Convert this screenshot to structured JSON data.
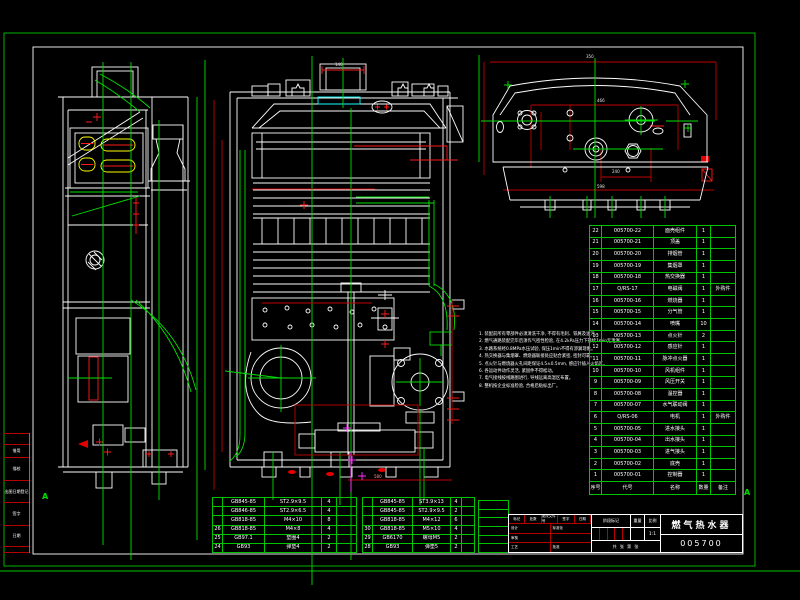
{
  "drawing": {
    "title": "燃气热水器",
    "drawing_number": "005700",
    "zone_marker": "A"
  },
  "margin_strip": {
    "labels": [
      "借用",
      "描校",
      "出图日期登记",
      "签字",
      "日期"
    ]
  },
  "dims": {
    "top_width": "350",
    "top_inner": "466",
    "top_mid": "240",
    "top_total": "598",
    "front_flue": "140",
    "front_bottom": "580"
  },
  "notes": {
    "lines": [
      "1. 装配前所有零部件必须清洗干净, 不得有毛刺、铁屑及油污。",
      "2. 燃气通路装配完毕后须作气密性检验, 在4.2kPa压力下持续1min无泄漏。",
      "3. 水路系统经0.8MPa水压试验, 保压1min不得有渗漏现象。",
      "4. 热交换器与集烟罩、燃烧器联接处应贴合紧密, 密封可靠。",
      "5. 点火针与燃烧器火孔间距保证4.5±0.5mm, 感应针插入火焰区。",
      "6. 各运动件动作灵活, 紧固件不得松动。",
      "7. 电气接线按线路图进行, 导线远离高温区布置。",
      "8. 整机按企业标准检验, 合格后贴标出厂。"
    ]
  },
  "bom": {
    "headers": {
      "no": "序号",
      "code": "代号",
      "name": "名称",
      "qty": "数量",
      "note": "备注"
    },
    "rows": [
      {
        "no": "22",
        "code": "005700-22",
        "name": "面壳组件",
        "qty": "1",
        "note": ""
      },
      {
        "no": "21",
        "code": "005700-21",
        "name": "顶盖",
        "qty": "1",
        "note": ""
      },
      {
        "no": "20",
        "code": "005700-20",
        "name": "排烟管",
        "qty": "1",
        "note": ""
      },
      {
        "no": "19",
        "code": "005700-19",
        "name": "集烟罩",
        "qty": "1",
        "note": ""
      },
      {
        "no": "18",
        "code": "005700-18",
        "name": "热交换器",
        "qty": "1",
        "note": ""
      },
      {
        "no": "17",
        "code": "Q/RS-17",
        "name": "电磁阀",
        "qty": "1",
        "note": "外购件"
      },
      {
        "no": "16",
        "code": "005700-16",
        "name": "燃烧器",
        "qty": "1",
        "note": ""
      },
      {
        "no": "15",
        "code": "005700-15",
        "name": "分气管",
        "qty": "1",
        "note": ""
      },
      {
        "no": "14",
        "code": "005700-14",
        "name": "喷嘴",
        "qty": "10",
        "note": ""
      },
      {
        "no": "13",
        "code": "005700-13",
        "name": "点火针",
        "qty": "2",
        "note": ""
      },
      {
        "no": "12",
        "code": "005700-12",
        "name": "感应针",
        "qty": "1",
        "note": ""
      },
      {
        "no": "11",
        "code": "005700-11",
        "name": "脉冲点火器",
        "qty": "1",
        "note": ""
      },
      {
        "no": "10",
        "code": "005700-10",
        "name": "风机组件",
        "qty": "1",
        "note": ""
      },
      {
        "no": "9",
        "code": "005700-09",
        "name": "风压开关",
        "qty": "1",
        "note": ""
      },
      {
        "no": "8",
        "code": "005700-08",
        "name": "温控器",
        "qty": "1",
        "note": ""
      },
      {
        "no": "7",
        "code": "005700-07",
        "name": "水气联动阀",
        "qty": "1",
        "note": ""
      },
      {
        "no": "6",
        "code": "Q/RS-06",
        "name": "电机",
        "qty": "1",
        "note": "外购件"
      },
      {
        "no": "5",
        "code": "005700-05",
        "name": "进水接头",
        "qty": "1",
        "note": ""
      },
      {
        "no": "4",
        "code": "005700-04",
        "name": "出水接头",
        "qty": "1",
        "note": ""
      },
      {
        "no": "3",
        "code": "005700-03",
        "name": "进气接头",
        "qty": "1",
        "note": ""
      },
      {
        "no": "2",
        "code": "005700-02",
        "name": "底壳",
        "qty": "1",
        "note": ""
      },
      {
        "no": "1",
        "code": "005700-01",
        "name": "控制器",
        "qty": "1",
        "note": ""
      }
    ]
  },
  "bottom_table_left": {
    "rows": [
      {
        "no": "",
        "code": "GB845-85",
        "name": "ST2.9×9.5",
        "qty": "4",
        "note": ""
      },
      {
        "no": "",
        "code": "GB846-85",
        "name": "ST2.9×6.5",
        "qty": "4",
        "note": ""
      },
      {
        "no": "",
        "code": "GB818-85",
        "name": "M4×10",
        "qty": "8",
        "note": ""
      },
      {
        "no": "26",
        "code": "GB818-85",
        "name": "M4×8",
        "qty": "4",
        "note": ""
      },
      {
        "no": "25",
        "code": "GB97.1",
        "name": "垫圈4",
        "qty": "2",
        "note": ""
      },
      {
        "no": "24",
        "code": "GB93",
        "name": "弹垫4",
        "qty": "2",
        "note": ""
      }
    ]
  },
  "bottom_table_right": {
    "rows": [
      {
        "no": "",
        "code": "GB845-85",
        "name": "ST3.9×13",
        "qty": "4",
        "note": ""
      },
      {
        "no": "",
        "code": "GB845-85",
        "name": "ST2.9×9.5",
        "qty": "2",
        "note": ""
      },
      {
        "no": "",
        "code": "GB818-85",
        "name": "M4×12",
        "qty": "6",
        "note": ""
      },
      {
        "no": "30",
        "code": "GB818-85",
        "name": "M5×10",
        "qty": "4",
        "note": ""
      },
      {
        "no": "29",
        "code": "GB6170",
        "name": "螺母M5",
        "qty": "2",
        "note": ""
      },
      {
        "no": "28",
        "code": "GB93",
        "name": "弹垫5",
        "qty": "2",
        "note": ""
      }
    ]
  },
  "title_block": {
    "rev_header": [
      "标记",
      "处数",
      "更改文件号",
      "签字",
      "日期"
    ],
    "roles_col1": [
      "设计",
      "审核",
      "工艺"
    ],
    "roles_col2": [
      "标准化",
      "",
      "批准"
    ],
    "stage_label": "阶段标记",
    "weight_label": "重量",
    "scale_label": "比例",
    "scale_value": "1:1",
    "sheet_info": "共 张 第 张"
  }
}
